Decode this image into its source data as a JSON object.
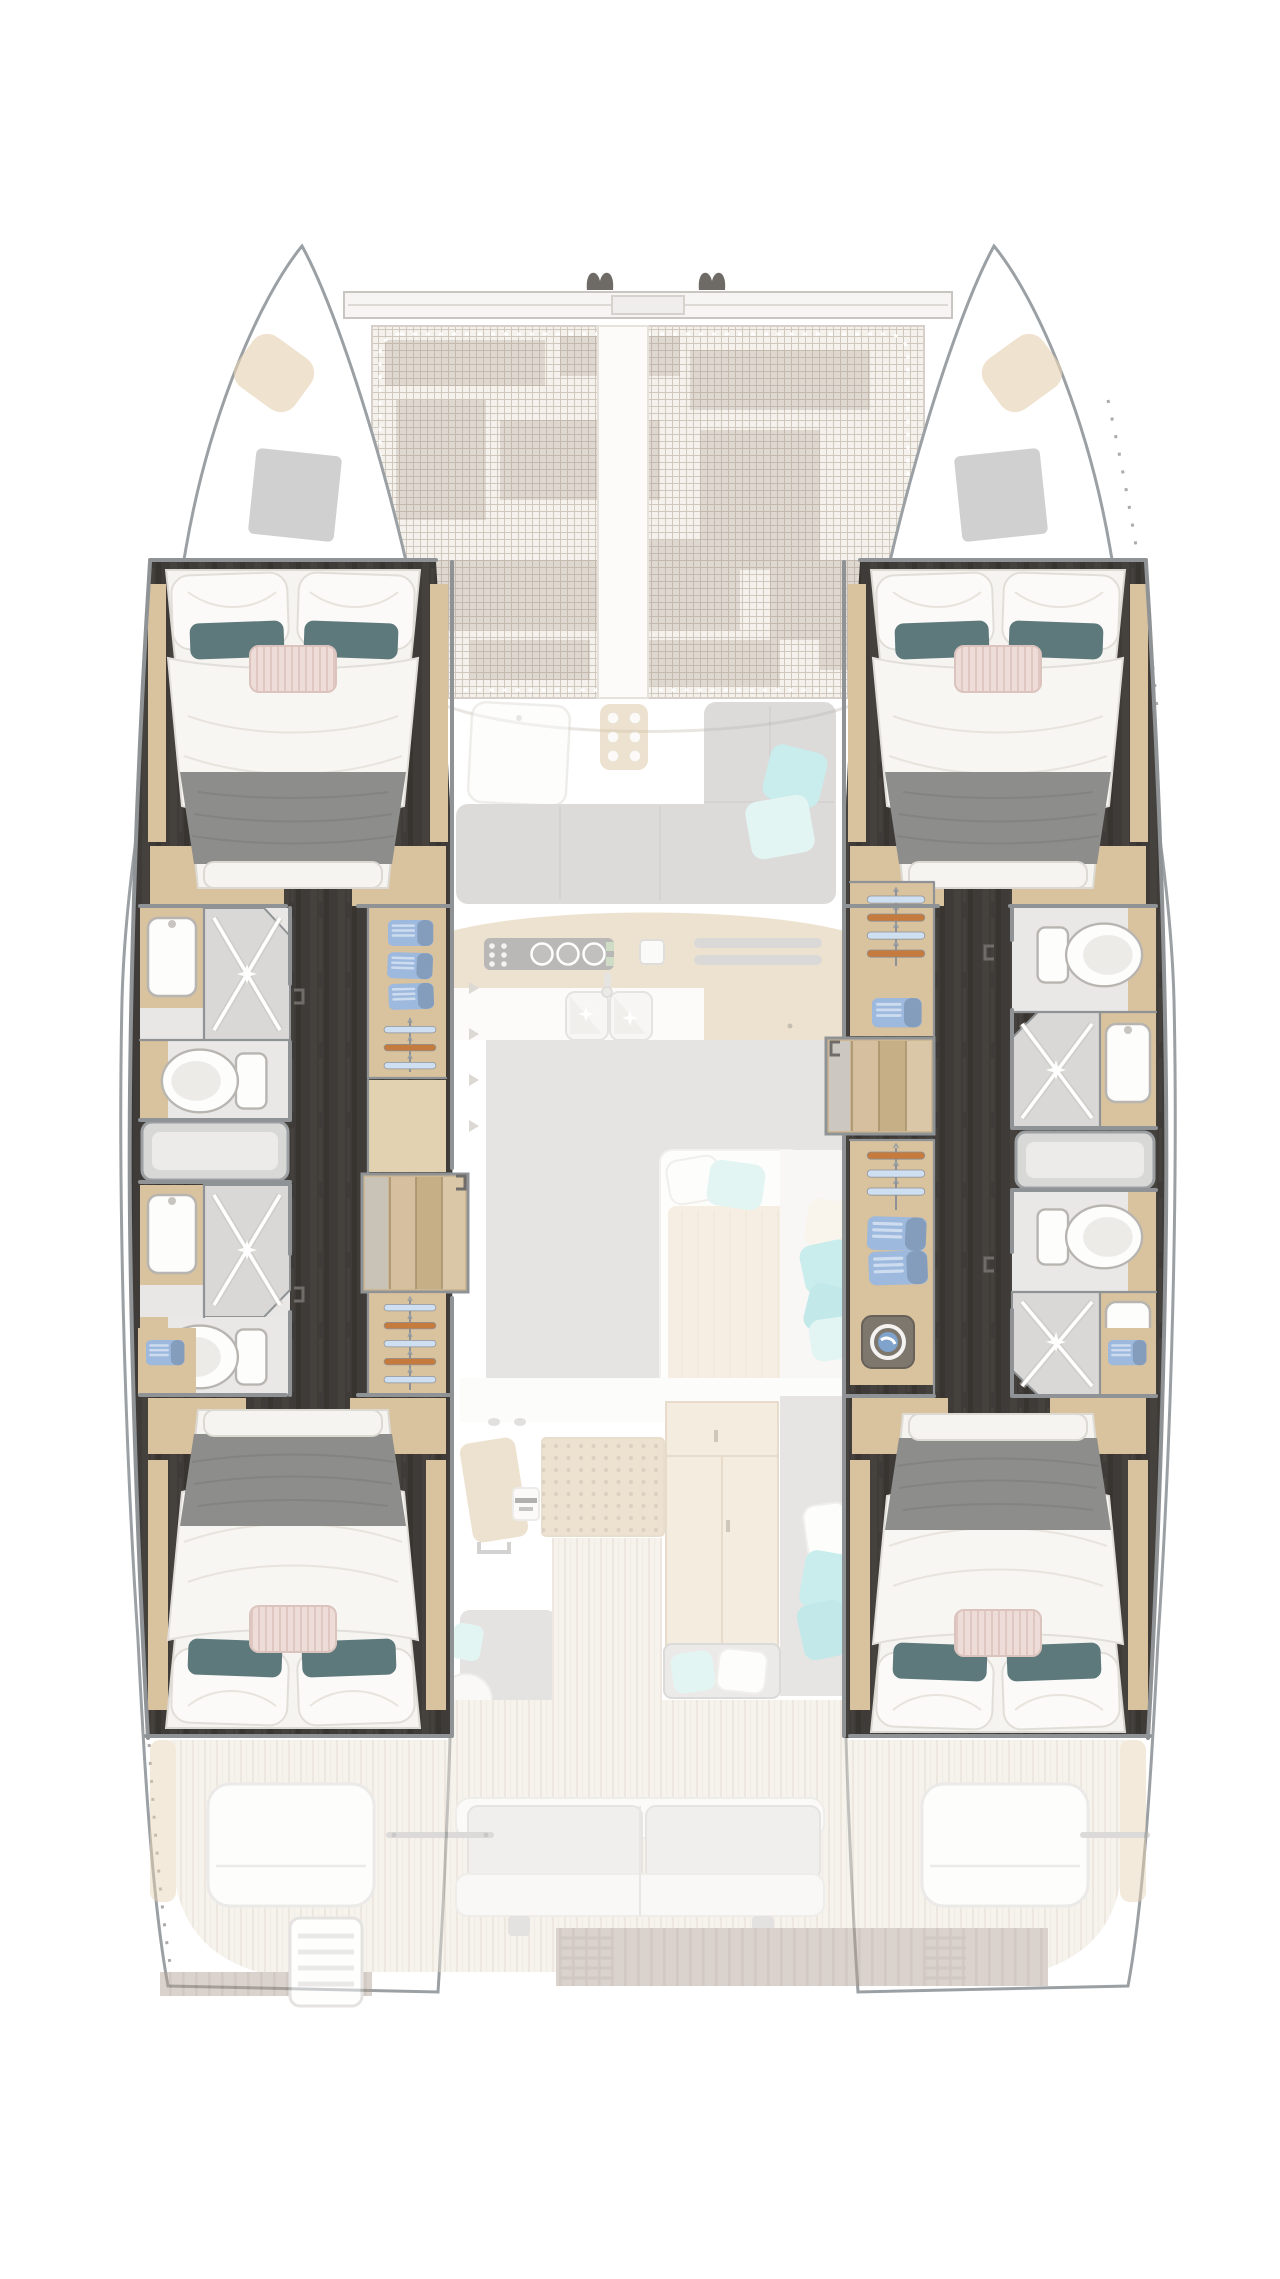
{
  "scene": {
    "type": "catamaran-accommodation-floor-plan",
    "view": "overhead deck plan, bow at top, no text labels in image",
    "hulls": 2,
    "double_cabins": 4,
    "bathrooms": 4,
    "shower_stalls": 4,
    "toilets": 4,
    "trampoline": true,
    "galley_burners": 3,
    "wardrobe_hanger_rows": [
      3,
      5,
      4,
      3
    ],
    "folded_towels_visible": 9,
    "washing_machine": 1,
    "aft_sofa_seats": 2,
    "boarding_ladder": true
  },
  "colors": {
    "hullStroke": "#9ba0a4",
    "wallGray": "#8f9396",
    "wood": "#d9c29e",
    "woodLight": "#e4d3b4",
    "stepsWood": "#cdb793",
    "floorDark": "#3f3b38",
    "tile": "#d9d8d6",
    "porcelain": "#fdfdfc",
    "duvet": "#f5f4f1",
    "blanket": "#8d8d8b",
    "blanketLine": "#7b7b79",
    "pillowTeal": "#5d797c",
    "pillowPink": "#eddbd7",
    "pinkStripe": "#dfc6c0",
    "towelBlue": "#9db9de",
    "towelRoll": "#7d9dce",
    "hangerBlue": "#cfdff2",
    "hangerOrange": "#c57a3e",
    "meshBase": "#f5f2ee",
    "meshLine": "#d0c8bd",
    "meshPatch": "#a4968a",
    "teakBase": "#ede5d9",
    "teakLine": "#d9cdbd",
    "platform": "#b2a294",
    "platformLine": "#9f8e80",
    "sofaGray": "#b7b5b2",
    "sofaSeam": "#a6a4a1",
    "soleGray": "#c8c6c3",
    "tealBright": "#8ed7da",
    "tealMint": "#c3ebe5",
    "padTan": "#e6d3b3",
    "hatchGray": "#b7b7b6",
    "cleatDark": "#6e6a66",
    "washerBody": "#7e776e",
    "washerBlue": "#7fa3cc",
    "perfDot": "#8f7e61"
  }
}
